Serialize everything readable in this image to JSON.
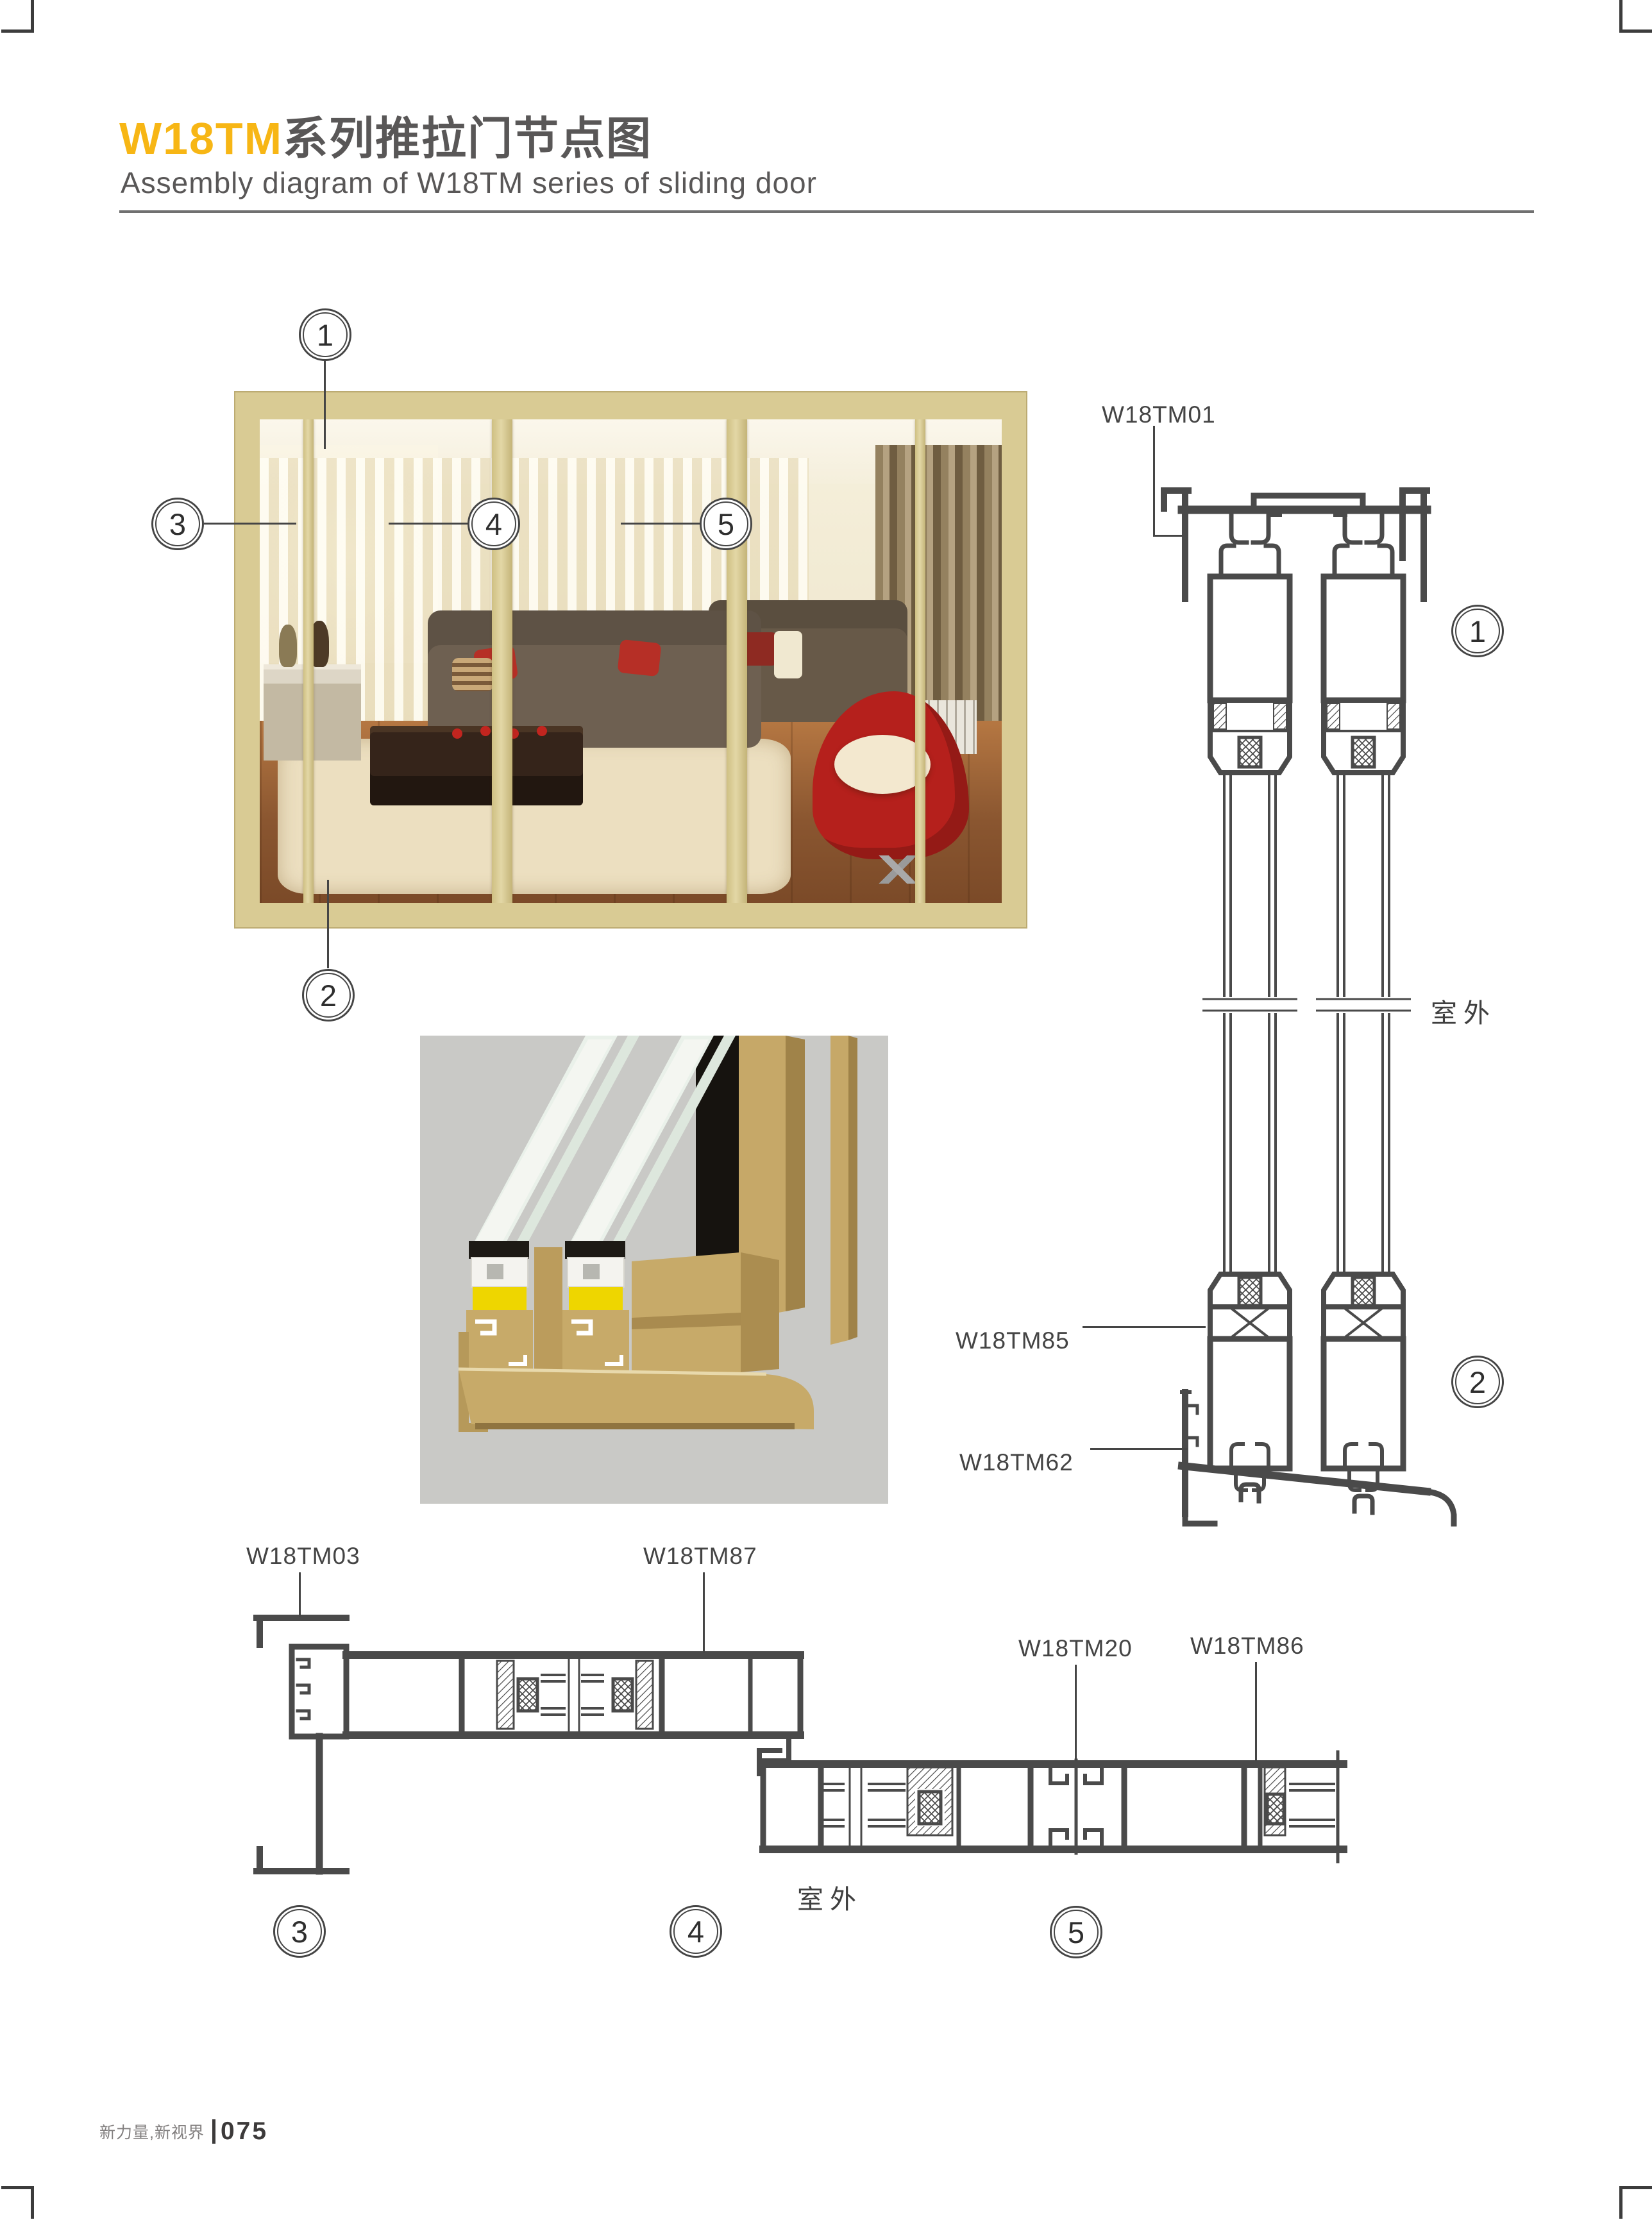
{
  "page": {
    "title_highlight": "W18TM",
    "title_rest": "系列推拉门节点图",
    "subtitle": "Assembly diagram of W18TM series of sliding door"
  },
  "footer": {
    "brand": "新力量,新视界",
    "page_number": "075"
  },
  "colors": {
    "accent_yellow": "#F7B615",
    "heading_gray": "#595757",
    "cad_line": "#4A4A4A",
    "frame_beige": "#D9CB94",
    "gasket_yellow": "#EED600",
    "render_background": "#C9C9C6"
  },
  "callouts": {
    "n1": "1",
    "n2": "2",
    "n3": "3",
    "n4": "4",
    "n5": "5"
  },
  "vertical_section": {
    "outdoor_label": "室外",
    "parts": {
      "top_track": "W18TM01",
      "sash_bottom": "W18TM85",
      "sill": "W18TM62"
    }
  },
  "horizontal_section": {
    "outdoor_label": "室外",
    "parts": {
      "jamb": "W18TM03",
      "interlock": "W18TM87",
      "mullion": "W18TM20",
      "lock_stile": "W18TM86"
    }
  }
}
